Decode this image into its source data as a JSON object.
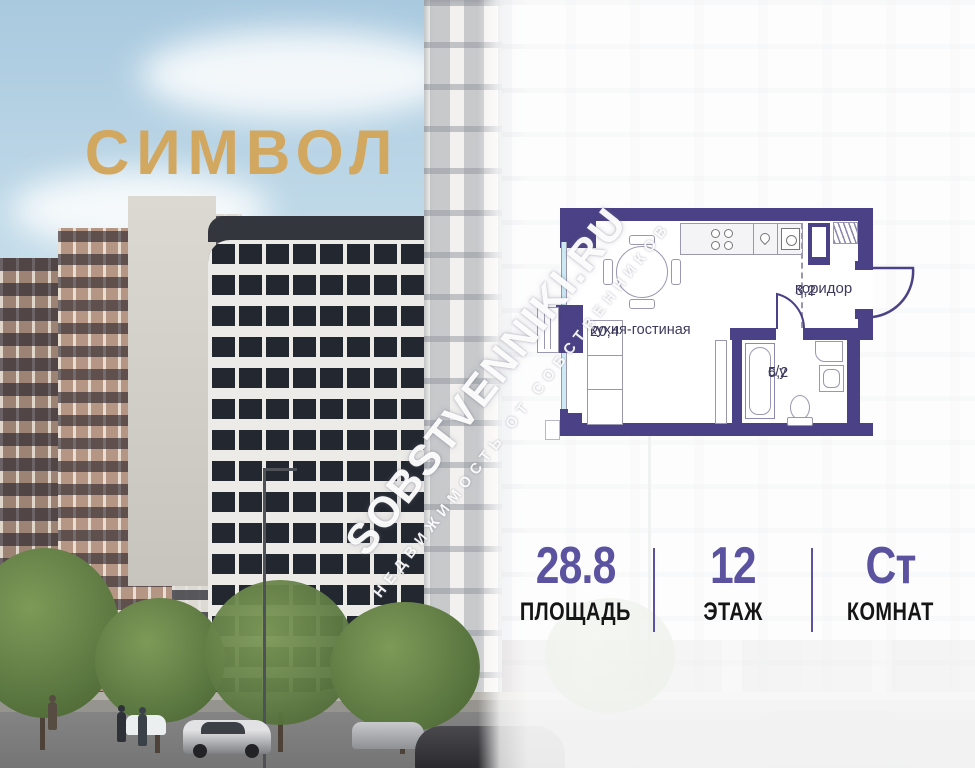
{
  "colors": {
    "accent": "#5b52a0",
    "wall": "#4a4186",
    "logo_gold": "#d2a75f",
    "plan_label": "#3e3a5e"
  },
  "logo": {
    "text": "СИМВОЛ"
  },
  "watermark": {
    "line1": "SOBSTVENNIKI.RU",
    "line2": "НЕДВИЖИМОСТЬ ОТ СОБСТВЕННИКОВ"
  },
  "floor_plan": {
    "rooms": [
      {
        "name": "кухня-гостиная",
        "area": "20,4"
      },
      {
        "name": "коридор",
        "area": "3,2"
      },
      {
        "name": "с/у",
        "area": "5,2"
      }
    ]
  },
  "stats": {
    "items": [
      {
        "value": "28.8",
        "label": "ПЛОЩАДЬ"
      },
      {
        "value": "12",
        "label": "ЭТАЖ"
      },
      {
        "value": "Ст",
        "label": "КОМНАТ"
      }
    ]
  }
}
